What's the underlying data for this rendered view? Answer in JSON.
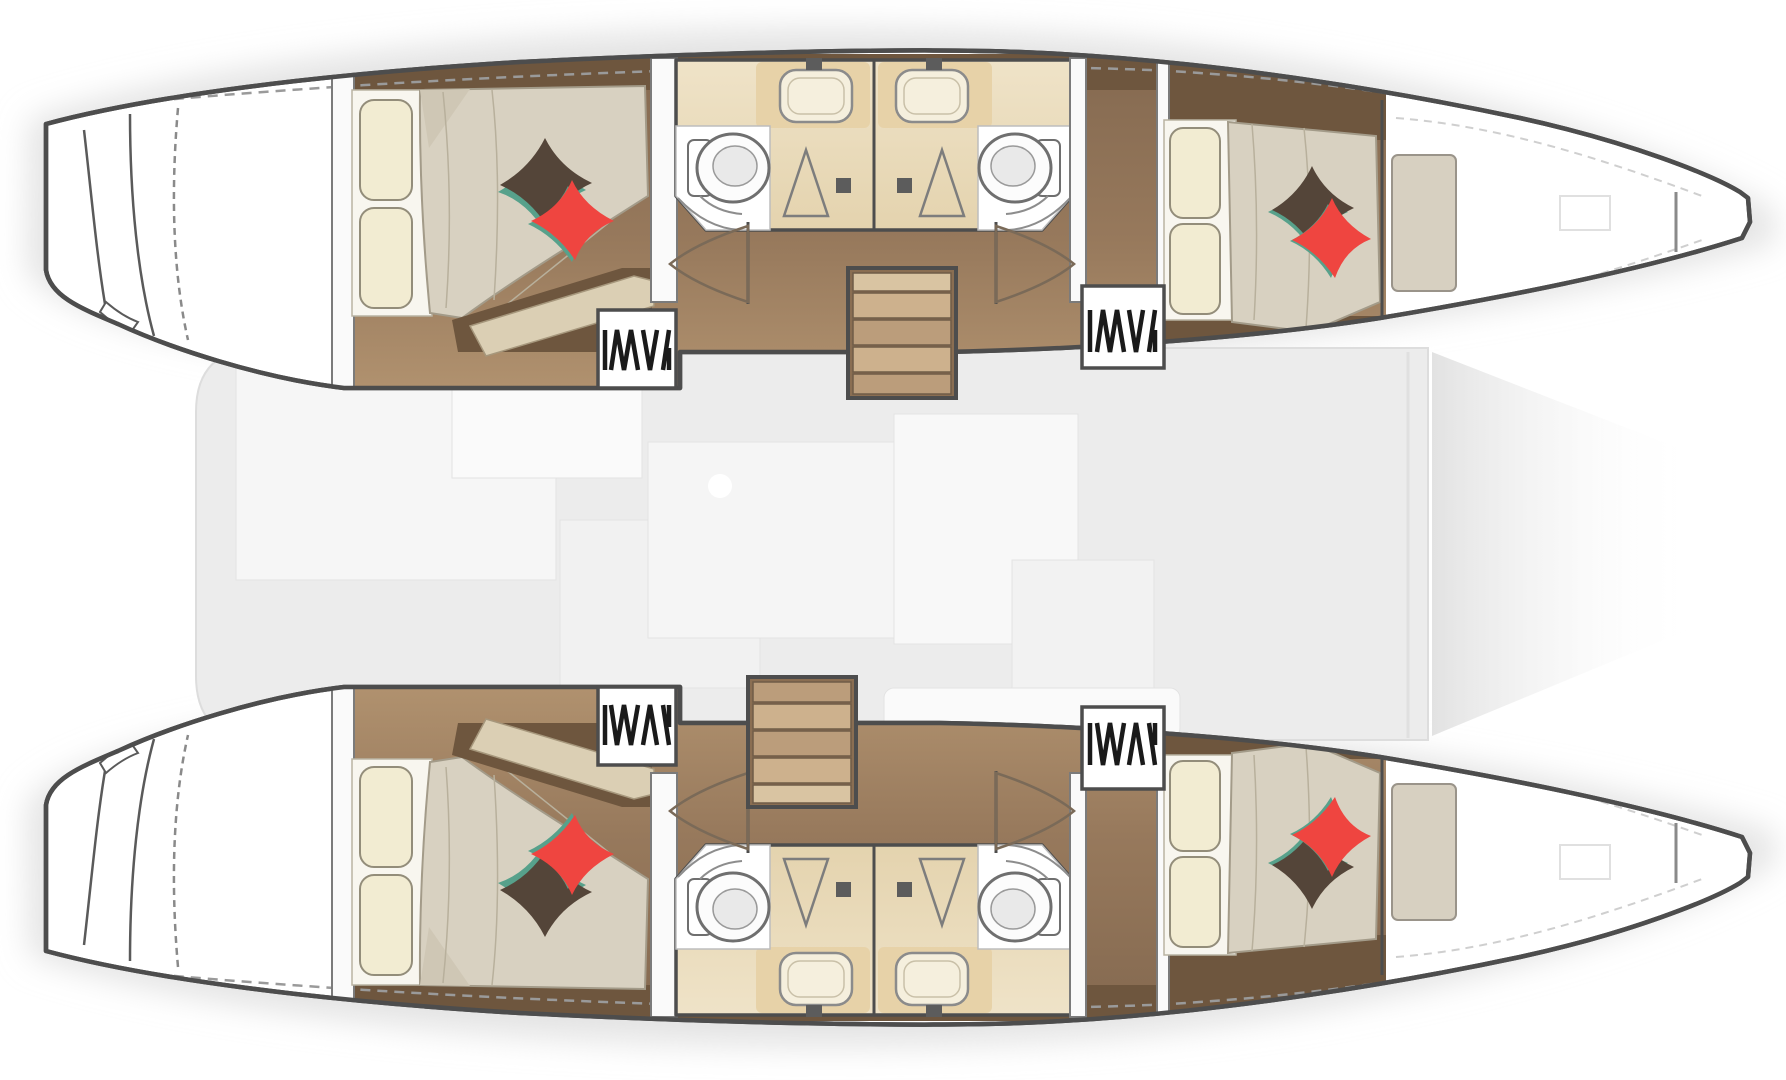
{
  "meta": {
    "title": "Catamaran yacht interior layout — top-view floor plan",
    "diagram_type": "floorplan",
    "orientation": {
      "bow": "right",
      "stern": "left"
    },
    "style_note": "hull accommodations rendered in full color; central bridgedeck salon shown faded"
  },
  "colors": {
    "outline": "#4d4d4d",
    "hull_fill": "#ffffff",
    "deck": "#ececec",
    "wood_top": "#846950",
    "wood_bottom": "#b1926f",
    "wood_dark": "#6e563e",
    "bath_top": "#efe3c8",
    "bath_bottom": "#e4d3ae",
    "counter": "#e7d2a8",
    "sink": "#f5efdd",
    "sheet": "#f8f6ef",
    "pillow": "#f2ecd2",
    "duvet": "#d8d1c1",
    "pillow_dark": "#544539",
    "pillow_red": "#ef4540",
    "pillow_teal": "#57a18b",
    "bench": "#dbcfb4",
    "berth_ext": "#d7d0c1",
    "stair_light": "#cdb18d",
    "stair_dark": "#bb9d7b",
    "shadow": "#d9d9d9",
    "furniture_faint": "#f6f6f6"
  },
  "hulls": [
    {
      "id": "port-hull",
      "position": "top",
      "rooms": [
        {
          "name": "transom-steps"
        },
        {
          "name": "aft-cabin",
          "features": [
            "double-bed",
            "two-cream-pillows",
            "dark-accent-pillow",
            "red-accent-pillow",
            "foot-bench"
          ]
        },
        {
          "name": "hanging-locker-aft"
        },
        {
          "name": "aft-head",
          "features": [
            "toilet",
            "sink",
            "shower"
          ]
        },
        {
          "name": "forward-head",
          "features": [
            "toilet",
            "sink",
            "shower"
          ]
        },
        {
          "name": "companionway-stairs"
        },
        {
          "name": "hanging-locker-forward"
        },
        {
          "name": "forward-cabin",
          "features": [
            "double-bed",
            "two-cream-pillows",
            "dark-accent-pillow",
            "red-accent-pillow"
          ]
        },
        {
          "name": "bow-berth-extension"
        },
        {
          "name": "bow-locker"
        }
      ]
    },
    {
      "id": "starboard-hull",
      "position": "bottom",
      "mirror_of": "port-hull",
      "rooms": [
        {
          "name": "transom-steps"
        },
        {
          "name": "aft-cabin",
          "features": [
            "double-bed",
            "two-cream-pillows",
            "dark-accent-pillow",
            "red-accent-pillow",
            "foot-bench"
          ]
        },
        {
          "name": "hanging-locker-aft"
        },
        {
          "name": "aft-head",
          "features": [
            "toilet",
            "sink",
            "shower"
          ]
        },
        {
          "name": "forward-head",
          "features": [
            "toilet",
            "sink",
            "shower"
          ]
        },
        {
          "name": "companionway-stairs"
        },
        {
          "name": "hanging-locker-forward"
        },
        {
          "name": "forward-cabin",
          "features": [
            "double-bed",
            "two-cream-pillows",
            "dark-accent-pillow",
            "red-accent-pillow"
          ]
        },
        {
          "name": "bow-berth-extension"
        },
        {
          "name": "bow-locker"
        }
      ]
    }
  ],
  "bridgedeck": {
    "name": "salon-and-cockpit",
    "style": "faded",
    "features": [
      "galley-blocks",
      "salon-table",
      "seating",
      "sun-pad"
    ]
  }
}
